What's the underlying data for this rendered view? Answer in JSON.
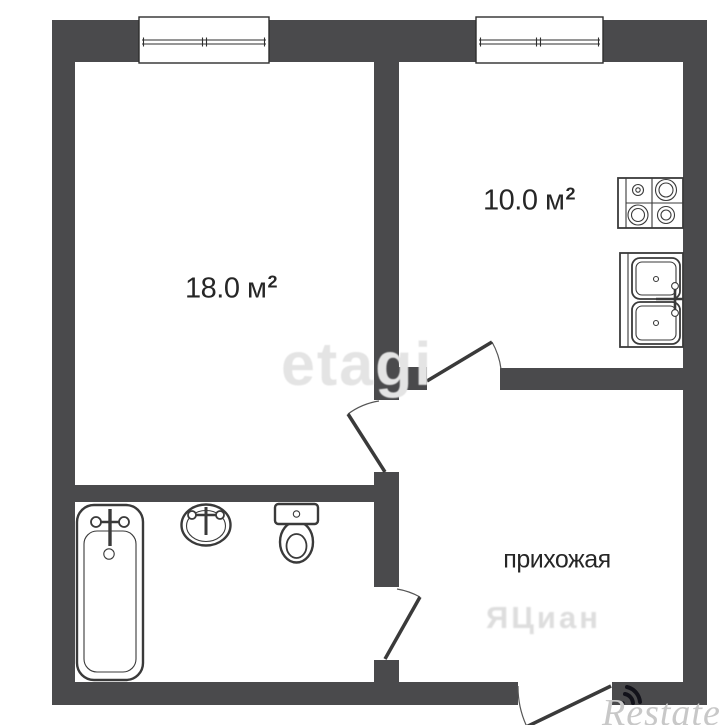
{
  "plan": {
    "rooms": [
      {
        "name": "living-room",
        "area": "18.0 м",
        "sup": "2"
      },
      {
        "name": "kitchen",
        "area": "10.0 м",
        "sup": "2"
      },
      {
        "name": "hallway",
        "label": "прихожая"
      }
    ],
    "fixture_icons": [
      "bathtub-icon",
      "bath-sink-icon",
      "toilet-icon",
      "stove-icon",
      "kitchen-sink-icon"
    ],
    "window_count": 2,
    "door_count": 4
  },
  "watermarks": {
    "etagi": "etagi",
    "cian": "ЯЦиан",
    "restate": "Restate"
  },
  "colors": {
    "wall": "#4a4a4c",
    "fixture_stroke": "#3a3a3a",
    "label_text": "#262626",
    "watermark_light": "#e4e4e4",
    "restate_text": "#c8c8c8",
    "restate_logo": "#12121a"
  }
}
